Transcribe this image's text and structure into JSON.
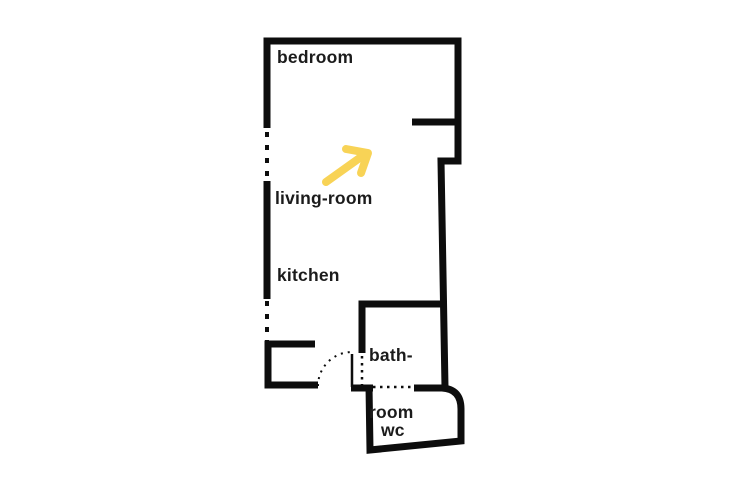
{
  "floorplan": {
    "background_color": "#ffffff",
    "wall_color": "#0d0d0d",
    "rooms": {
      "bedroom": {
        "label": "bedroom"
      },
      "living_room": {
        "label": "living-room"
      },
      "kitchen": {
        "label": "kitchen"
      },
      "bathroom": {
        "label_line1": "bath-",
        "label_line2": "room"
      },
      "wc": {
        "label": "wc"
      }
    },
    "arrow": {
      "color": "#f8d356",
      "direction": "up-right",
      "location": "living-room"
    }
  }
}
